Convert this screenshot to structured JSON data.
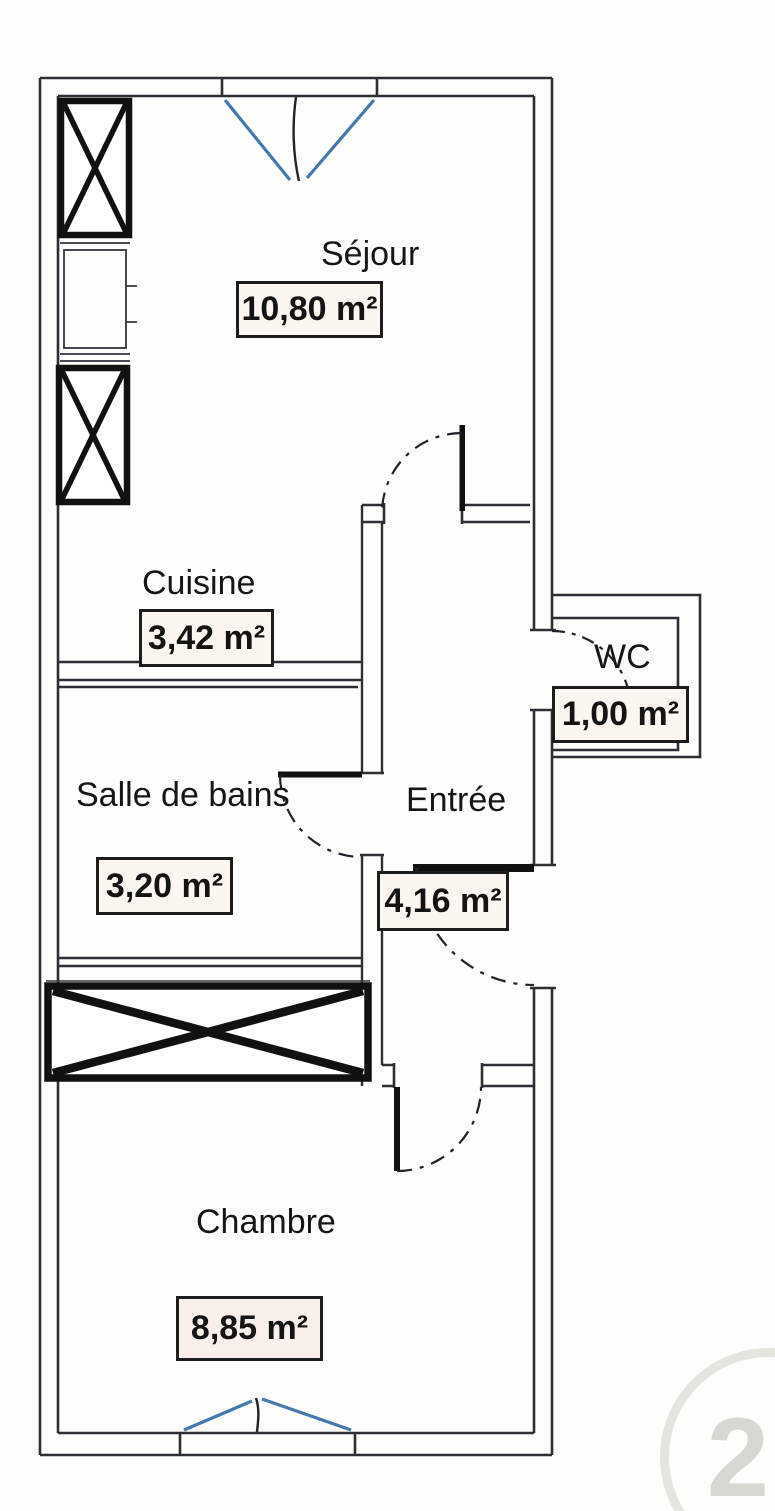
{
  "plan": {
    "type": "apartment-floor-plan",
    "language": "fr",
    "watermark": "21"
  },
  "rooms": [
    {
      "id": "sejour",
      "name": "Séjour",
      "area": "10,80 m²"
    },
    {
      "id": "cuisine",
      "name": "Cuisine",
      "area": "3,42 m²"
    },
    {
      "id": "sdb",
      "name": "Salle de bains",
      "area": "3,20 m²"
    },
    {
      "id": "entree",
      "name": "Entrée",
      "area": "4,16 m²"
    },
    {
      "id": "wc",
      "name": "WC",
      "area": "1,00 m²"
    },
    {
      "id": "chambre",
      "name": "Chambre",
      "area": "8,85 m²"
    }
  ],
  "symbols": {
    "window-icon": "blue casement V marks in wall opening",
    "door-swing-icon": "dash-dot quarter-circle arc with black leaf",
    "closet-icon": "thick rectangle crossed with X",
    "kitchen-unit-icon": "thin counter rectangle with tick marks"
  },
  "colors": {
    "wall": "#2e2e35",
    "door_leaf": "#111111",
    "window_accent": "#4579ae",
    "label_bg": "#fbf6f0",
    "label_border": "#1d1d1d",
    "paper": "#fdfdfb"
  }
}
